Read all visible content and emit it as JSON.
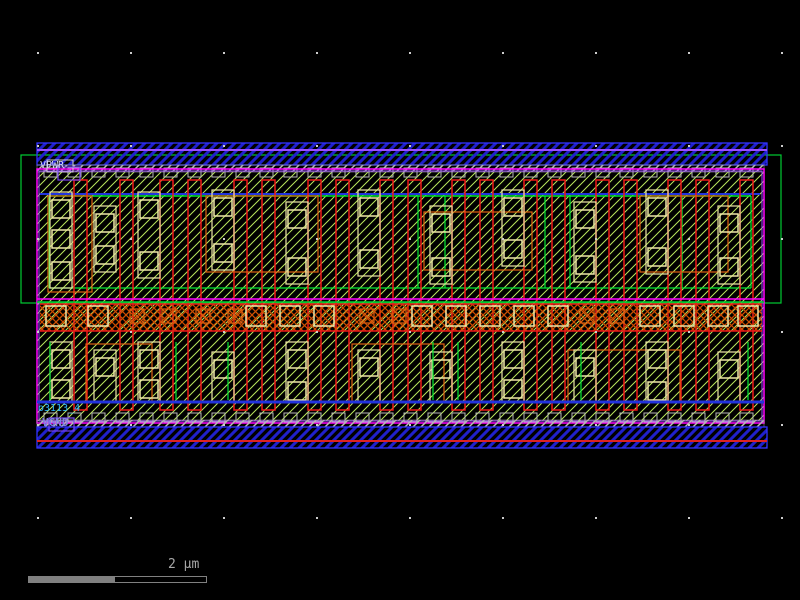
{
  "window": {
    "width": 800,
    "height": 600,
    "background": "#000000"
  },
  "labels": {
    "vpwr": {
      "text": "VPWR",
      "color": "#D8D8F8"
    },
    "vgnd": {
      "text": "VGND",
      "color": "#8080E8"
    },
    "instance": {
      "text": "o3113_4",
      "color": "#2FB8FF"
    }
  },
  "scalebar": {
    "label": "2 μm",
    "color": "#A8A8A8",
    "bar_color": "#808080"
  },
  "colors": {
    "background": "#000000",
    "cell_hatch": "#B9E65C",
    "metal1_edge": "#3333FF",
    "metal1_hatch": "#2020CC",
    "violet": "#9B4DFF",
    "magenta": "#FF00FF",
    "li_gray": "#B8B8B8",
    "well_green": "#00CC33",
    "diff_green": "#00E833",
    "poly_red": "#F01818",
    "contact_cream": "#EFE8A8",
    "orange": "#E06010",
    "mid_orange": "#D04C00",
    "blue_route": "#2233DD",
    "rail_red_line": "#DD2222",
    "grid_dot": "#CCCCCC",
    "pin_purple": "#7744EE",
    "pin_white": "#D0D0D0"
  },
  "geometry": {
    "well": {
      "x": 21,
      "y": 155,
      "w": 760,
      "h": 148
    },
    "hatch_area": {
      "x": 37,
      "y": 172,
      "w": 727,
      "h": 249
    },
    "boundary": {
      "x": 37,
      "y": 169,
      "w": 727,
      "h": 254
    },
    "boundary_inner": {
      "x": 39,
      "y": 171,
      "w": 723,
      "h": 250
    },
    "rail_top": {
      "x": 37,
      "y": 143,
      "w": 730,
      "h": 22
    },
    "rail_bottom": {
      "x": 37,
      "y": 427,
      "w": 730,
      "h": 21
    },
    "violet_line_top_y": 150,
    "red_line_bottom_y": 441,
    "li_strip_top": {
      "x": 37,
      "y": 165,
      "w": 727,
      "h": 7
    },
    "li_strip_bottom": {
      "x": 37,
      "y": 420,
      "w": 727,
      "h": 7
    },
    "li_tabs": {
      "w": 13,
      "h": 9,
      "step": 24,
      "x0": 44,
      "x1": 752,
      "top_y": 168,
      "bottom_y": 413
    },
    "blue_line_pmos_y": 194,
    "green_line_pmos_y": 196,
    "diff_bottom_y": 288,
    "green_vlines_pmos": [
      418,
      445,
      545,
      570,
      682
    ],
    "green_vlines_nmos": [
      50,
      176,
      228,
      433,
      458,
      581,
      748
    ],
    "mid": {
      "magenta_y": 299,
      "green_y": 302,
      "band_x": 40,
      "band_y": 304,
      "band_w": 722,
      "band_h": 27
    },
    "blue_line_nmos_y": 402,
    "gates": {
      "xs": [
        74,
        120,
        160,
        188,
        234,
        262,
        308,
        336,
        380,
        408,
        452,
        480,
        524,
        552,
        596,
        624,
        668,
        696,
        740
      ],
      "w": 13,
      "y1": 180,
      "y2": 410
    },
    "pmos_columns": [
      {
        "x": 50,
        "squares": [
          200,
          230,
          262
        ]
      },
      {
        "x": 94,
        "squares": [
          214,
          246
        ]
      },
      {
        "x": 138,
        "squares": [
          200,
          252
        ]
      },
      {
        "x": 212,
        "squares": [
          198,
          244
        ]
      },
      {
        "x": 286,
        "squares": [
          210,
          258
        ]
      },
      {
        "x": 358,
        "squares": [
          198,
          250
        ]
      },
      {
        "x": 430,
        "squares": [
          214,
          258
        ]
      },
      {
        "x": 502,
        "squares": [
          198,
          240
        ]
      },
      {
        "x": 574,
        "squares": [
          210,
          256
        ]
      },
      {
        "x": 646,
        "squares": [
          198,
          248
        ]
      },
      {
        "x": 718,
        "squares": [
          214,
          258
        ]
      }
    ],
    "nmos_columns": [
      {
        "x": 50,
        "squares": [
          350,
          380
        ]
      },
      {
        "x": 94,
        "squares": [
          358
        ]
      },
      {
        "x": 138,
        "squares": [
          350,
          380
        ]
      },
      {
        "x": 212,
        "squares": [
          360
        ]
      },
      {
        "x": 286,
        "squares": [
          350,
          382
        ]
      },
      {
        "x": 358,
        "squares": [
          358
        ]
      },
      {
        "x": 430,
        "squares": [
          360
        ]
      },
      {
        "x": 502,
        "squares": [
          350,
          380
        ]
      },
      {
        "x": 574,
        "squares": [
          358
        ]
      },
      {
        "x": 646,
        "squares": [
          350,
          382
        ]
      },
      {
        "x": 718,
        "squares": [
          360
        ]
      }
    ],
    "square_size": 18,
    "column_w": 22,
    "mid_squares": {
      "y": 306,
      "size": 20,
      "xs": [
        46,
        88,
        246,
        280,
        314,
        412,
        446,
        480,
        514,
        548,
        640,
        674,
        708,
        738
      ]
    },
    "mid_xsquares": {
      "y": 309,
      "size": 14,
      "xs": [
        130,
        162,
        196,
        228,
        360,
        392,
        580,
        610
      ]
    },
    "orange_rects": [
      [
        48,
        196,
        44,
        96
      ],
      [
        206,
        196,
        112,
        76
      ],
      [
        424,
        212,
        108,
        58
      ],
      [
        640,
        196,
        88,
        76
      ],
      [
        86,
        344,
        66,
        58
      ],
      [
        352,
        344,
        92,
        58
      ],
      [
        568,
        350,
        112,
        52
      ]
    ],
    "pin_boxes": {
      "top_white": [
        47,
        160,
        26,
        12
      ],
      "top_purple": [
        58,
        167,
        22,
        13
      ],
      "bottom_purple": [
        49,
        418,
        25,
        13
      ]
    },
    "grid": {
      "xs": [
        37,
        130,
        223,
        316,
        409,
        502,
        595,
        688,
        781
      ],
      "ys": [
        52,
        145,
        238,
        331,
        424,
        517
      ]
    },
    "scalebar": {
      "x": 28,
      "y": 576,
      "filled_w": 86,
      "outline_w": 93,
      "h": 7
    }
  }
}
